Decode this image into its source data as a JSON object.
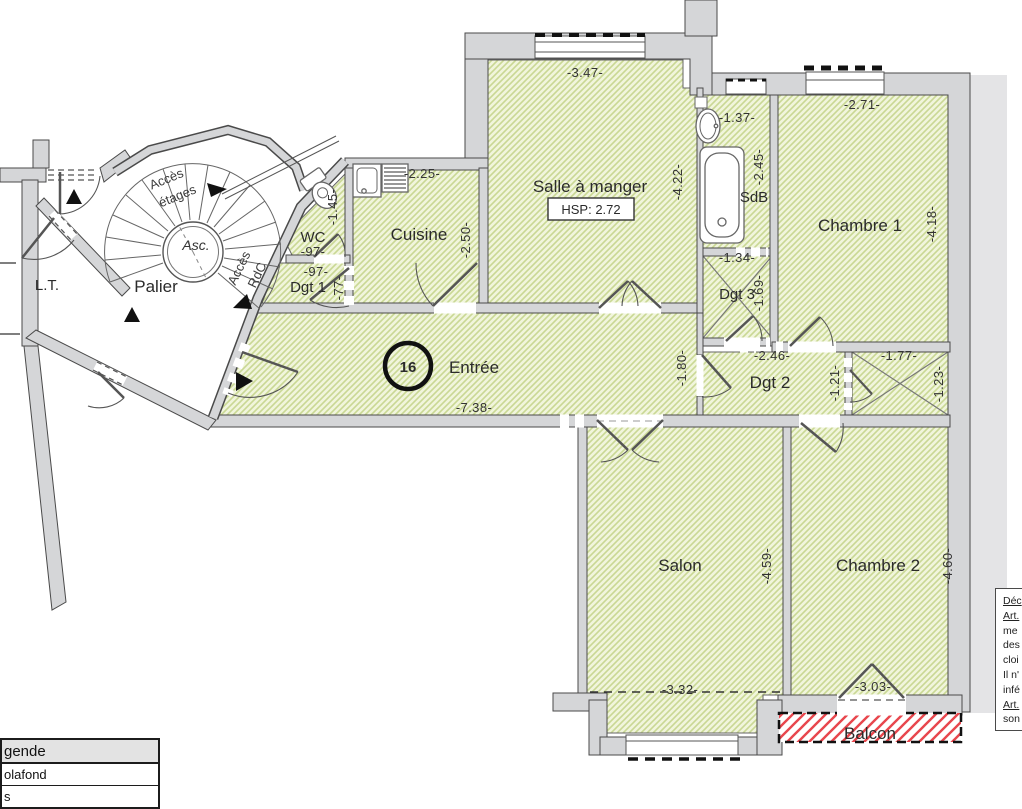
{
  "plan": {
    "rooms": {
      "palier": "Palier",
      "lt": "L.T.",
      "wc": "WC",
      "dgt1": "Dgt 1",
      "cuisine": "Cuisine",
      "salle_a_manger": "Salle à manger",
      "sdb": "SdB",
      "dgt3": "Dgt 3",
      "chambre1": "Chambre 1",
      "entree": "Entrée",
      "dgt2": "Dgt 2",
      "salon": "Salon",
      "chambre2": "Chambre 2",
      "balcon": "Balcon"
    },
    "lot_number": "16",
    "hsp": "HSP: 2.72",
    "stairs": {
      "asc": "Asc.",
      "etages1": "Accès",
      "etages2": "étages",
      "rdc1": "Accès",
      "rdc2": "RdC"
    },
    "dimensions": {
      "salle_top": "-3.47-",
      "salle_right": "-4.22-",
      "cuisine_top": "-2.25-",
      "cuisine_right": "-2.50-",
      "wc_width": "-97-",
      "wc_depth": "-1.45-",
      "dgt1_width": "-97-",
      "dgt1_depth": "-77-",
      "sdb_sink": "-1.37-",
      "sdb_height": "-2.45-",
      "dgt3_top": "-1.34-",
      "dgt3_right": "-1.69-",
      "chambre1_top": "-2.71-",
      "chambre1_right": "-4.18-",
      "entree_length": "-7.38-",
      "entree_width": "-1.80-",
      "dgt2_top": "-2.46-",
      "dgt2_right": "-1.21-",
      "placard_top": "-1.77-",
      "placard_right": "-1.23-",
      "salon_bottom": "-3.32-",
      "salon_right": "-4.59-",
      "chambre2_bottom": "-3.03-",
      "chambre2_right": "-4.60-"
    }
  },
  "legend": {
    "title": "gende",
    "row1": "olafond",
    "row2": "s"
  },
  "note": {
    "l1": "Déc",
    "l2": "Art.",
    "l3": "me",
    "l4": "des",
    "l5": "cloi",
    "l6": "Il n'",
    "l7": "infé",
    "l8": "Art.",
    "l9": "son"
  },
  "colors": {
    "room_fill": "#f1f5dc",
    "room_hatch": "#c9d894",
    "wall": "#d5d6d8",
    "balcony_stripe": "#e8464d"
  }
}
